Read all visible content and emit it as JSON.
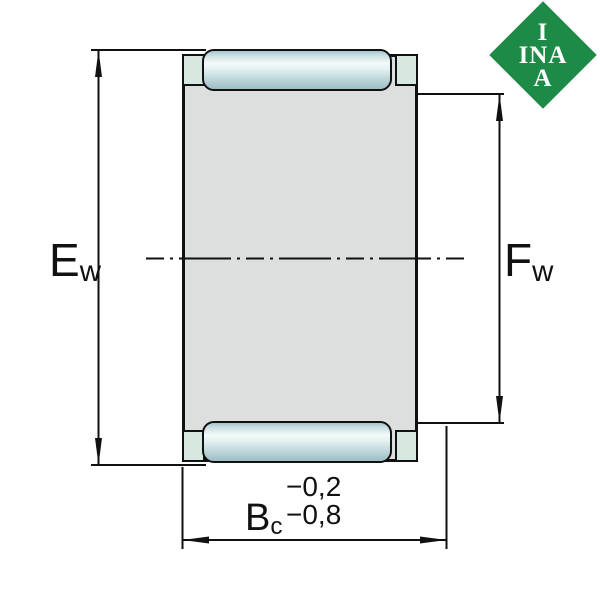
{
  "logo": {
    "name": "INA",
    "lines": [
      "I",
      "INA",
      "A"
    ]
  },
  "labels": {
    "ew": {
      "symbol": "E",
      "subscript": "w"
    },
    "fw": {
      "symbol": "F",
      "subscript": "w"
    },
    "bc": {
      "symbol": "B",
      "subscript": "c",
      "tolerance_upper": "−0,2",
      "tolerance_lower": "−0,8"
    }
  },
  "colors": {
    "logo-green": "#1E8A47",
    "body-gray": "#DDDEDE",
    "lip-mint": "#D7E8E1",
    "roller-teal": "#9BBEC5",
    "line-black": "#111111"
  }
}
